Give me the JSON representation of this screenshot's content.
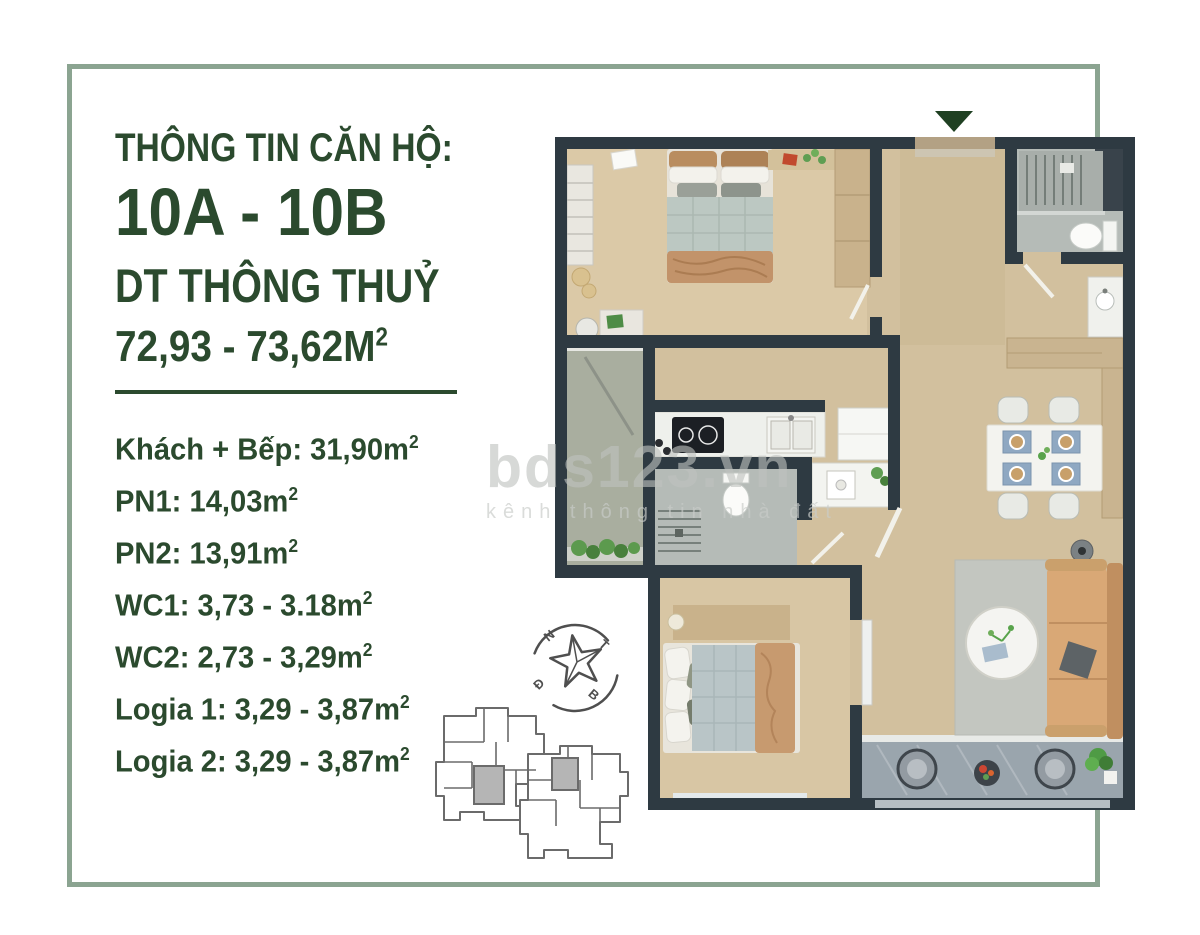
{
  "info": {
    "header": "THÔNG TIN CĂN HỘ:",
    "unit": "10A - 10B",
    "area_label": "DT THÔNG THUỶ",
    "area_value": "72,93 - 73,62M",
    "area_sup": "2",
    "rooms": [
      {
        "text": "Khách + Bếp: 31,90m",
        "sup": "2"
      },
      {
        "text": "PN1: 14,03m",
        "sup": "2"
      },
      {
        "text": "PN2: 13,91m",
        "sup": "2"
      },
      {
        "text": "WC1: 3,73 - 3.18m",
        "sup": "2"
      },
      {
        "text": "WC2: 2,73 - 3,29m",
        "sup": "2"
      },
      {
        "text": "Logia 1: 3,29 - 3,87m",
        "sup": "2"
      },
      {
        "text": "Logia 2: 3,29 - 3,87m",
        "sup": "2"
      }
    ]
  },
  "watermark": {
    "brand": "bds123.vn",
    "tagline": "kênh thông tin nhà đất"
  },
  "compass": {
    "letters": {
      "n": "N",
      "t": "T",
      "d": "Đ",
      "b": "B"
    }
  },
  "colors": {
    "frame": "#8ba491",
    "text_green": "#2b4a2e",
    "divider": "#2b4a2e",
    "entrance_marker": "#1f4022",
    "walls": "#2e3a42",
    "wood_floor": "#d2c09e",
    "bedroom_floor": "#dbc9a7",
    "logia_stone": "#a9ae9f",
    "wc_marble": "#b5bbb7",
    "balcony_tile": "#9aa5ad",
    "sofa": "#d9a876",
    "keyplan_highlight": "#b5b5b5",
    "watermark_gray": "#c5c8c5"
  }
}
